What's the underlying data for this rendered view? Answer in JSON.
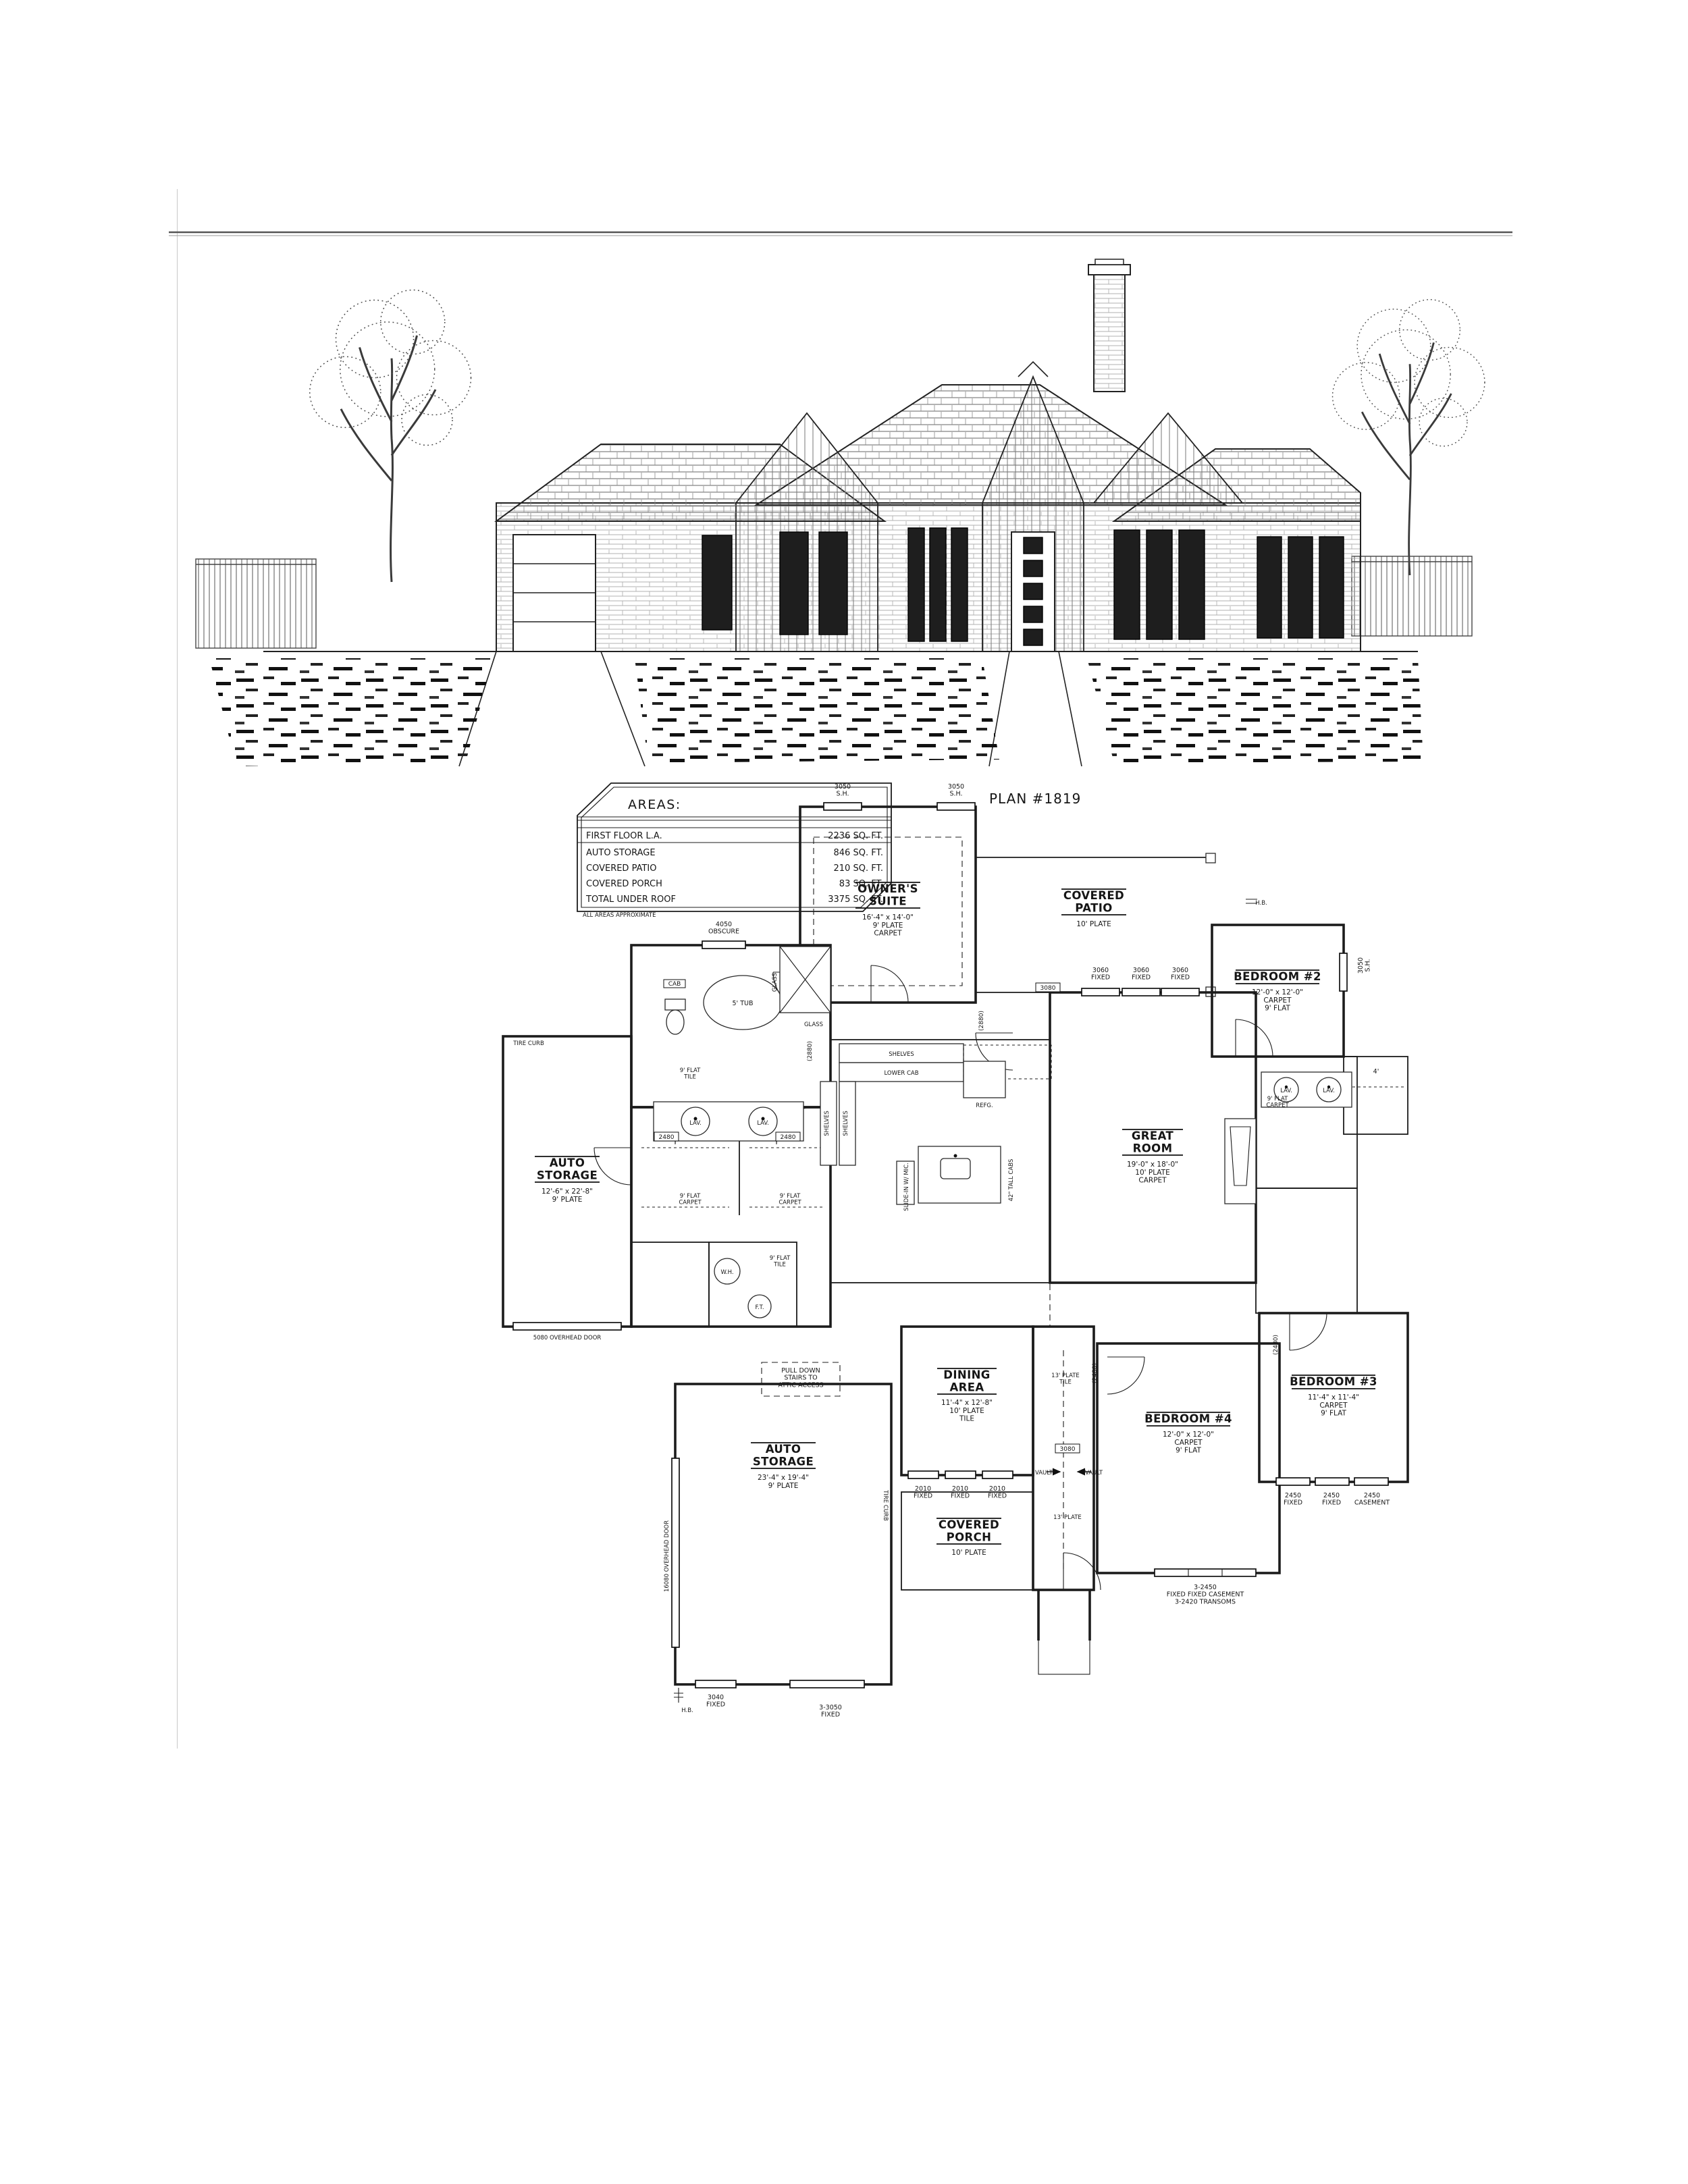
{
  "sheet": {
    "plan_title": "PLAN #1819"
  },
  "areas_table": {
    "title": "AREAS:",
    "rows": [
      {
        "label": "FIRST FLOOR L.A.",
        "value": "2236 SQ. FT."
      },
      {
        "label": "AUTO STORAGE",
        "value": "846 SQ. FT."
      },
      {
        "label": "COVERED PATIO",
        "value": "210 SQ. FT."
      },
      {
        "label": "COVERED PORCH",
        "value": "83 SQ. FT."
      },
      {
        "label": "TOTAL UNDER ROOF",
        "value": "3375 SQ. FT."
      }
    ],
    "footnote": "ALL AREAS APPROXIMATE"
  },
  "rooms": {
    "owners_suite": {
      "name": [
        "OWNER'S",
        "SUITE"
      ],
      "info": [
        "16'-4\" x 14'-0\"",
        "9' PLATE",
        "CARPET"
      ]
    },
    "covered_patio": {
      "name": [
        "COVERED",
        "PATIO"
      ],
      "info": [
        "10' PLATE"
      ]
    },
    "bedroom2": {
      "name": [
        "BEDROOM #2"
      ],
      "info": [
        "12'-0\" x 12'-0\"",
        "CARPET",
        "9' FLAT"
      ]
    },
    "great_room": {
      "name": [
        "GREAT",
        "ROOM"
      ],
      "info": [
        "19'-0\" x 18'-0\"",
        "10' PLATE",
        "CARPET"
      ]
    },
    "auto_storage_side": {
      "name": [
        "AUTO",
        "STORAGE"
      ],
      "info": [
        "12'-6\" x 22'-8\"",
        "9' PLATE"
      ]
    },
    "auto_storage_rear": {
      "name": [
        "AUTO",
        "STORAGE"
      ],
      "info": [
        "23'-4\" x 19'-4\"",
        "9' PLATE"
      ]
    },
    "dining_area": {
      "name": [
        "DINING",
        "AREA"
      ],
      "info": [
        "11'-4\" x 12'-8\"",
        "10' PLATE",
        "TILE"
      ]
    },
    "covered_porch": {
      "name": [
        "COVERED",
        "PORCH"
      ],
      "info": [
        "10' PLATE"
      ]
    },
    "bedroom4": {
      "name": [
        "BEDROOM #4"
      ],
      "info": [
        "12'-0\" x 12'-0\"",
        "CARPET",
        "9' FLAT"
      ]
    },
    "bedroom3": {
      "name": [
        "BEDROOM #3"
      ],
      "info": [
        "11'-4\" x 11'-4\"",
        "CARPET",
        "9' FLAT"
      ]
    }
  },
  "labels": {
    "sh3050": [
      "3050",
      "S.H."
    ],
    "obscure4050": [
      "4050",
      "OBSCURE"
    ],
    "fixed3060": [
      "3060",
      "FIXED"
    ],
    "fixed2010": [
      "2010",
      "FIXED"
    ],
    "fixed2450": [
      "2450",
      "FIXED"
    ],
    "casement2450": [
      "2450",
      "CASEMENT"
    ],
    "fixed3040": [
      "3040",
      "FIXED"
    ],
    "fixed3_3050": [
      "3-3050",
      "FIXED"
    ],
    "bed4_window": [
      "3-2450",
      "FIXED  FIXED  CASEMENT",
      "3-2420 TRANSOMS"
    ],
    "overhead5080": "5080 OVERHEAD DOOR",
    "overhead16080": "16080 OVERHEAD DOOR",
    "door3080": "3080",
    "door2880": "(2880)",
    "door2480": "2480",
    "door2480r": "(2480)",
    "tire_curb": "TIRE CURB",
    "attic": [
      "PULL DOWN",
      "STAIRS TO",
      "ATTIC ACCESS"
    ],
    "shelves": "SHELVES",
    "lower_cab": "LOWER CAB",
    "refg": "REFG.",
    "tub5": "5' TUB",
    "glass": "GLASS",
    "cab": "CAB",
    "lav": "LAV.",
    "wh": "W.H.",
    "ft": "F.T.",
    "hb": "H.B.",
    "vault": "VAULT",
    "plate13_tile": [
      "13' PLATE",
      "TILE"
    ],
    "plate13": "13' PLATE",
    "flat9_carpet": [
      "9' FLAT",
      "CARPET"
    ],
    "flat9_tile": [
      "9' FLAT",
      "TILE"
    ],
    "tall_cabs": "42\" TALL CABS",
    "range": "SLIDE-IN W/ MIC.",
    "dim4": "4'"
  }
}
